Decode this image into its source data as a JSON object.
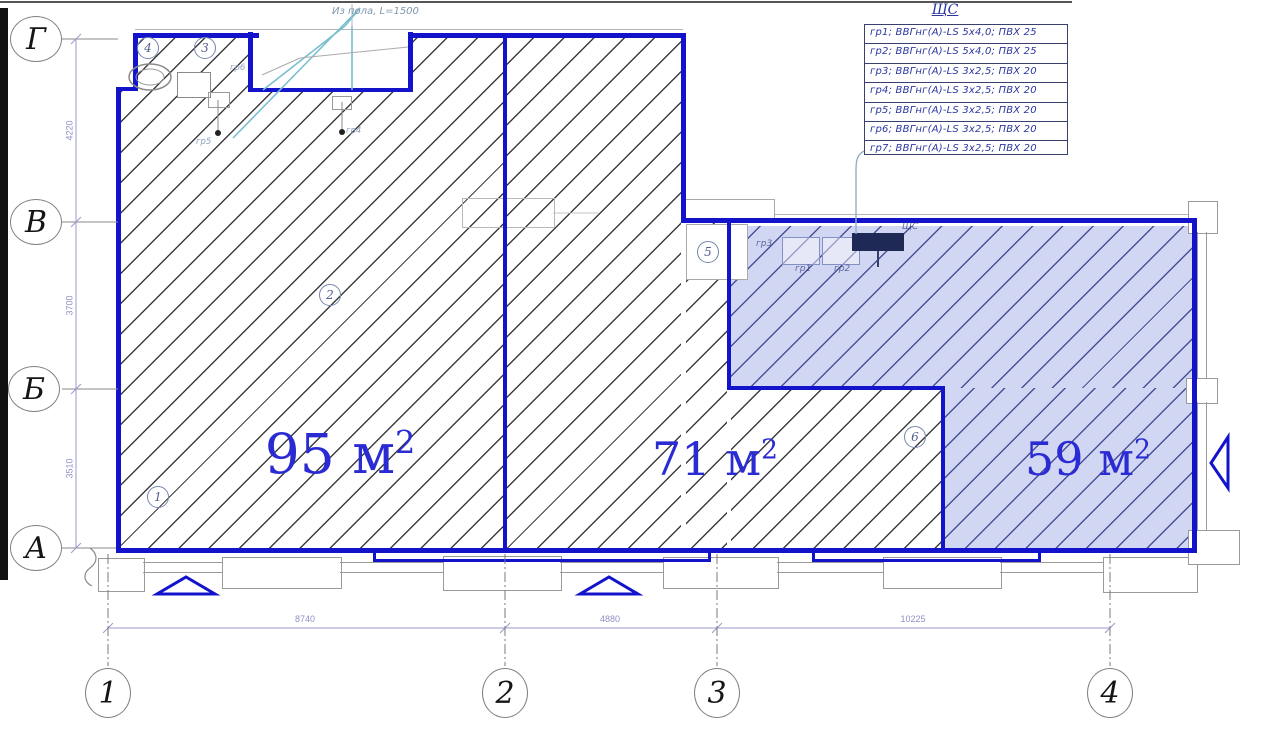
{
  "legend": {
    "title": "ЩС",
    "rows": [
      "гр1; ВВГнг(А)-LS 5х4,0; ПВХ 25",
      "гр2; ВВГнг(А)-LS 5х4,0; ПВХ 25",
      "гр3; ВВГнг(А)-LS 3х2,5; ПВХ 20",
      "гр4; ВВГнг(А)-LS 3х2,5; ПВХ 20",
      "гр5; ВВГнг(А)-LS 3х2,5; ПВХ 20",
      "гр6; ВВГнг(А)-LS 3х2,5; ПВХ 20",
      "гр7; ВВГнг(А)-LS 3х2,5; ПВХ 20"
    ]
  },
  "note_top": "Из пола, L=1500",
  "rooms": [
    {
      "area": "95"
    },
    {
      "area": "71"
    },
    {
      "area": "59"
    }
  ],
  "area_unit": "м",
  "area_sup": "2",
  "axes": {
    "rows": [
      "Г",
      "В",
      "Б",
      "А"
    ],
    "cols": [
      "1",
      "2",
      "3",
      "4"
    ],
    "row_dims": [
      "4220",
      "3700",
      "3510"
    ],
    "col_dims": [
      "8740",
      "4880",
      "10225"
    ]
  },
  "marks": [
    "1",
    "2",
    "3",
    "4",
    "5",
    "6"
  ],
  "equipment": {
    "gr5": "гр5",
    "gr4": "гр4",
    "gr6": "гр6",
    "gr3": "гр3",
    "gr1": "гр1",
    "gr2": "гр2",
    "shch": "ЩС"
  },
  "colors": {
    "wall_blue": "#1313cc",
    "area_text": "#2b2bd4",
    "zone_fill": "#6876d8",
    "legend_text": "#2b36a0",
    "dim_text": "#8f8fc8"
  }
}
